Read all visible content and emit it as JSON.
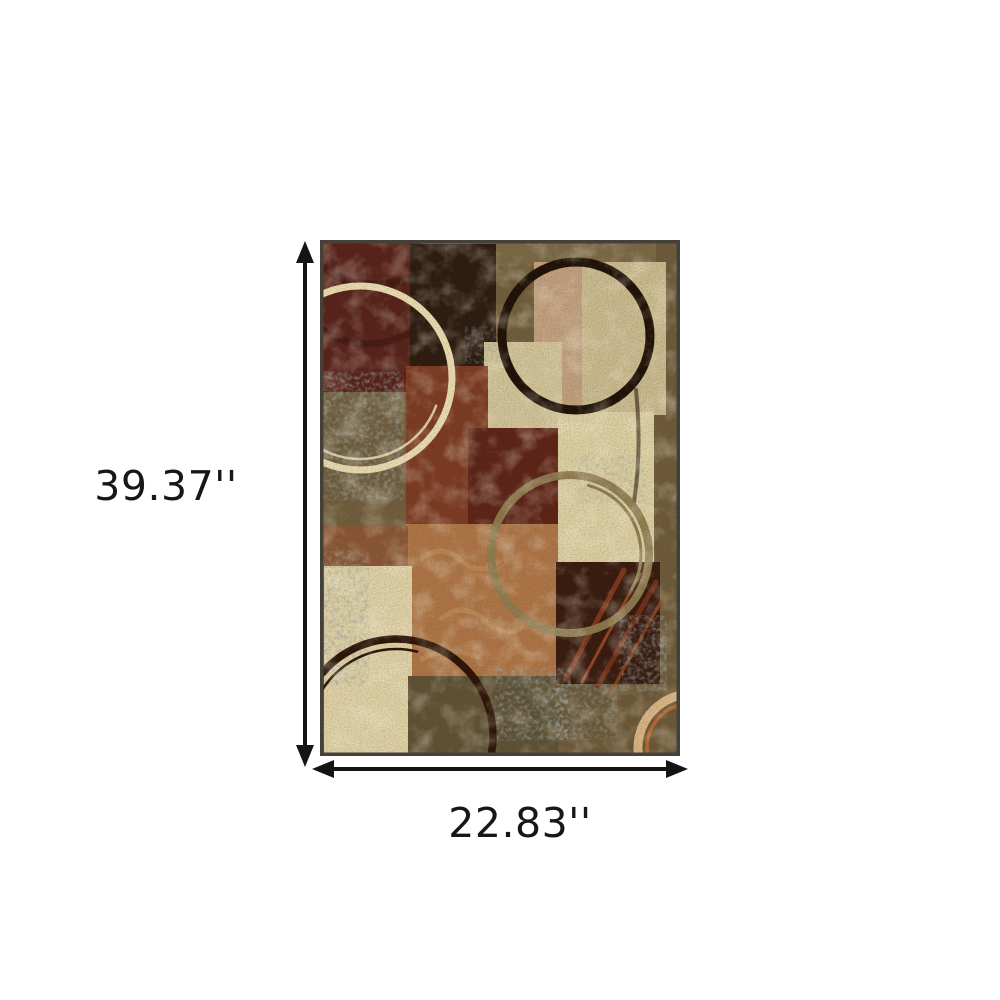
{
  "page": {
    "background": "#ffffff"
  },
  "dimension_annotations": {
    "color": "#141414",
    "height": {
      "label": "39.37''"
    },
    "width": {
      "label": "22.83''"
    }
  },
  "icons": {
    "height_arrow": "double-headed-vertical-arrow",
    "width_arrow": "double-headed-horizontal-arrow"
  },
  "rug": {
    "border": "#45413a",
    "palette": {
      "base": "#6f5d3c",
      "top_band": "#7a6845",
      "right_edge": "#6e5a3a",
      "maroon_tl": "#572119",
      "dark_brown": "#2b1a0e",
      "beige_square": "#cbbb8f",
      "salmon_wash": "#b5806a",
      "center_column": "#d2c498",
      "rust_red": "#7c3a22",
      "dark_red": "#5d2316",
      "cream_column": "#ddd0a2",
      "orange_center": "#ae7546",
      "maroon_streak": "#371a0e",
      "tan_band": "#8a5633",
      "cream_bottom_left": "#e0d2a6",
      "olive_bottom": "#5e5134",
      "brown_bottom": "#6b5838",
      "speckle_blue": "#51635e",
      "ring_cream": "#eadcb0",
      "ring_dark": "#1d1006",
      "ring_olive": "#8d7b4f",
      "ring_dark2": "#2b1306",
      "ring_peach": "#d9b483",
      "ring_orange": "#bc6a2e"
    }
  }
}
